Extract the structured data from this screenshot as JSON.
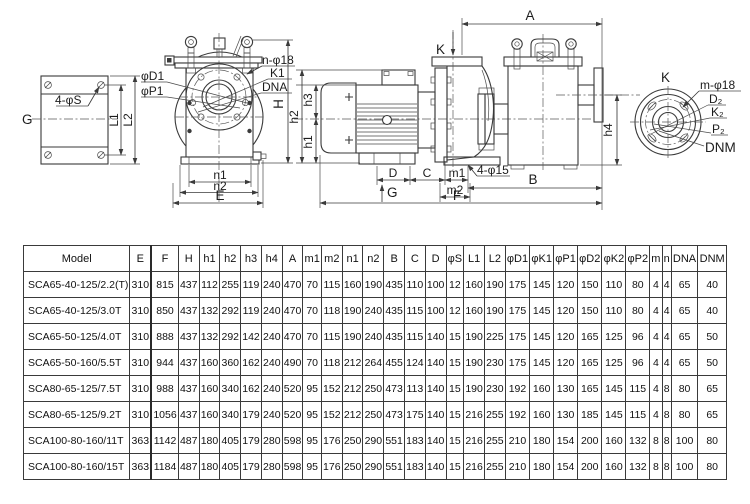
{
  "drawing": {
    "view_left": {
      "g": "G",
      "holes": "4-φS",
      "l1": "L1",
      "l2": "L2"
    },
    "view_front": {
      "phi_d1": "φD1",
      "phi_p1": "φP1",
      "n_holes": "n-φ18",
      "k1": "K1",
      "dna": "DNA",
      "h": "H",
      "n1": "n1",
      "n2": "n2",
      "e": "E"
    },
    "view_side": {
      "k": "K",
      "a": "A",
      "h1": "h1",
      "h2": "h2",
      "h3": "h3",
      "h4": "h4",
      "d": "D",
      "c": "C",
      "m1": "m1",
      "m2": "m2",
      "g": "G",
      "b": "B",
      "f": "F",
      "holes": "4-φ15"
    },
    "view_end": {
      "k": "K",
      "m_holes": "m-φ18",
      "d2": "D₂",
      "k2": "K₂",
      "p2": "P₂",
      "dnm": "DNM"
    }
  },
  "table": {
    "headers": [
      "Model",
      "E",
      "F",
      "H",
      "h1",
      "h2",
      "h3",
      "h4",
      "A",
      "m1",
      "m2",
      "n1",
      "n2",
      "B",
      "C",
      "D",
      "φS",
      "L1",
      "L2",
      "φD1",
      "φK1",
      "φP1",
      "φD2",
      "φK2",
      "φP2",
      "m",
      "n",
      "DNA",
      "DNM"
    ],
    "rows": [
      [
        "SCA65-40-125/2.2(T)",
        "310",
        "815",
        "437",
        "112",
        "255",
        "119",
        "240",
        "470",
        "70",
        "115",
        "160",
        "190",
        "435",
        "110",
        "100",
        "12",
        "160",
        "190",
        "175",
        "145",
        "120",
        "150",
        "110",
        "80",
        "4",
        "4",
        "65",
        "40"
      ],
      [
        "SCA65-40-125/3.0T",
        "310",
        "850",
        "437",
        "132",
        "292",
        "119",
        "240",
        "470",
        "70",
        "118",
        "190",
        "240",
        "435",
        "115",
        "100",
        "12",
        "160",
        "190",
        "175",
        "145",
        "120",
        "150",
        "110",
        "80",
        "4",
        "4",
        "65",
        "40"
      ],
      [
        "SCA65-50-125/4.0T",
        "310",
        "888",
        "437",
        "132",
        "292",
        "142",
        "240",
        "470",
        "70",
        "115",
        "190",
        "240",
        "435",
        "115",
        "140",
        "15",
        "190",
        "225",
        "175",
        "145",
        "120",
        "165",
        "125",
        "96",
        "4",
        "4",
        "65",
        "50"
      ],
      [
        "SCA65-50-160/5.5T",
        "310",
        "944",
        "437",
        "160",
        "360",
        "162",
        "240",
        "490",
        "70",
        "118",
        "212",
        "264",
        "455",
        "124",
        "140",
        "15",
        "190",
        "230",
        "175",
        "145",
        "120",
        "165",
        "125",
        "96",
        "4",
        "4",
        "65",
        "50"
      ],
      [
        "SCA80-65-125/7.5T",
        "310",
        "988",
        "437",
        "160",
        "340",
        "162",
        "240",
        "520",
        "95",
        "152",
        "212",
        "250",
        "473",
        "113",
        "140",
        "15",
        "190",
        "230",
        "192",
        "160",
        "130",
        "165",
        "145",
        "115",
        "4",
        "8",
        "80",
        "65"
      ],
      [
        "SCA80-65-125/9.2T",
        "310",
        "1056",
        "437",
        "160",
        "340",
        "179",
        "240",
        "520",
        "95",
        "152",
        "212",
        "250",
        "473",
        "175",
        "140",
        "15",
        "216",
        "255",
        "192",
        "160",
        "130",
        "185",
        "145",
        "115",
        "4",
        "8",
        "80",
        "65"
      ],
      [
        "SCA100-80-160/11T",
        "363",
        "1142",
        "487",
        "180",
        "405",
        "179",
        "280",
        "598",
        "95",
        "176",
        "250",
        "290",
        "551",
        "183",
        "140",
        "15",
        "216",
        "255",
        "210",
        "180",
        "154",
        "200",
        "160",
        "132",
        "8",
        "8",
        "100",
        "80"
      ],
      [
        "SCA100-80-160/15T",
        "363",
        "1184",
        "487",
        "180",
        "405",
        "179",
        "280",
        "598",
        "95",
        "176",
        "250",
        "290",
        "551",
        "183",
        "140",
        "15",
        "216",
        "255",
        "210",
        "180",
        "154",
        "200",
        "160",
        "132",
        "8",
        "8",
        "100",
        "80"
      ]
    ]
  }
}
